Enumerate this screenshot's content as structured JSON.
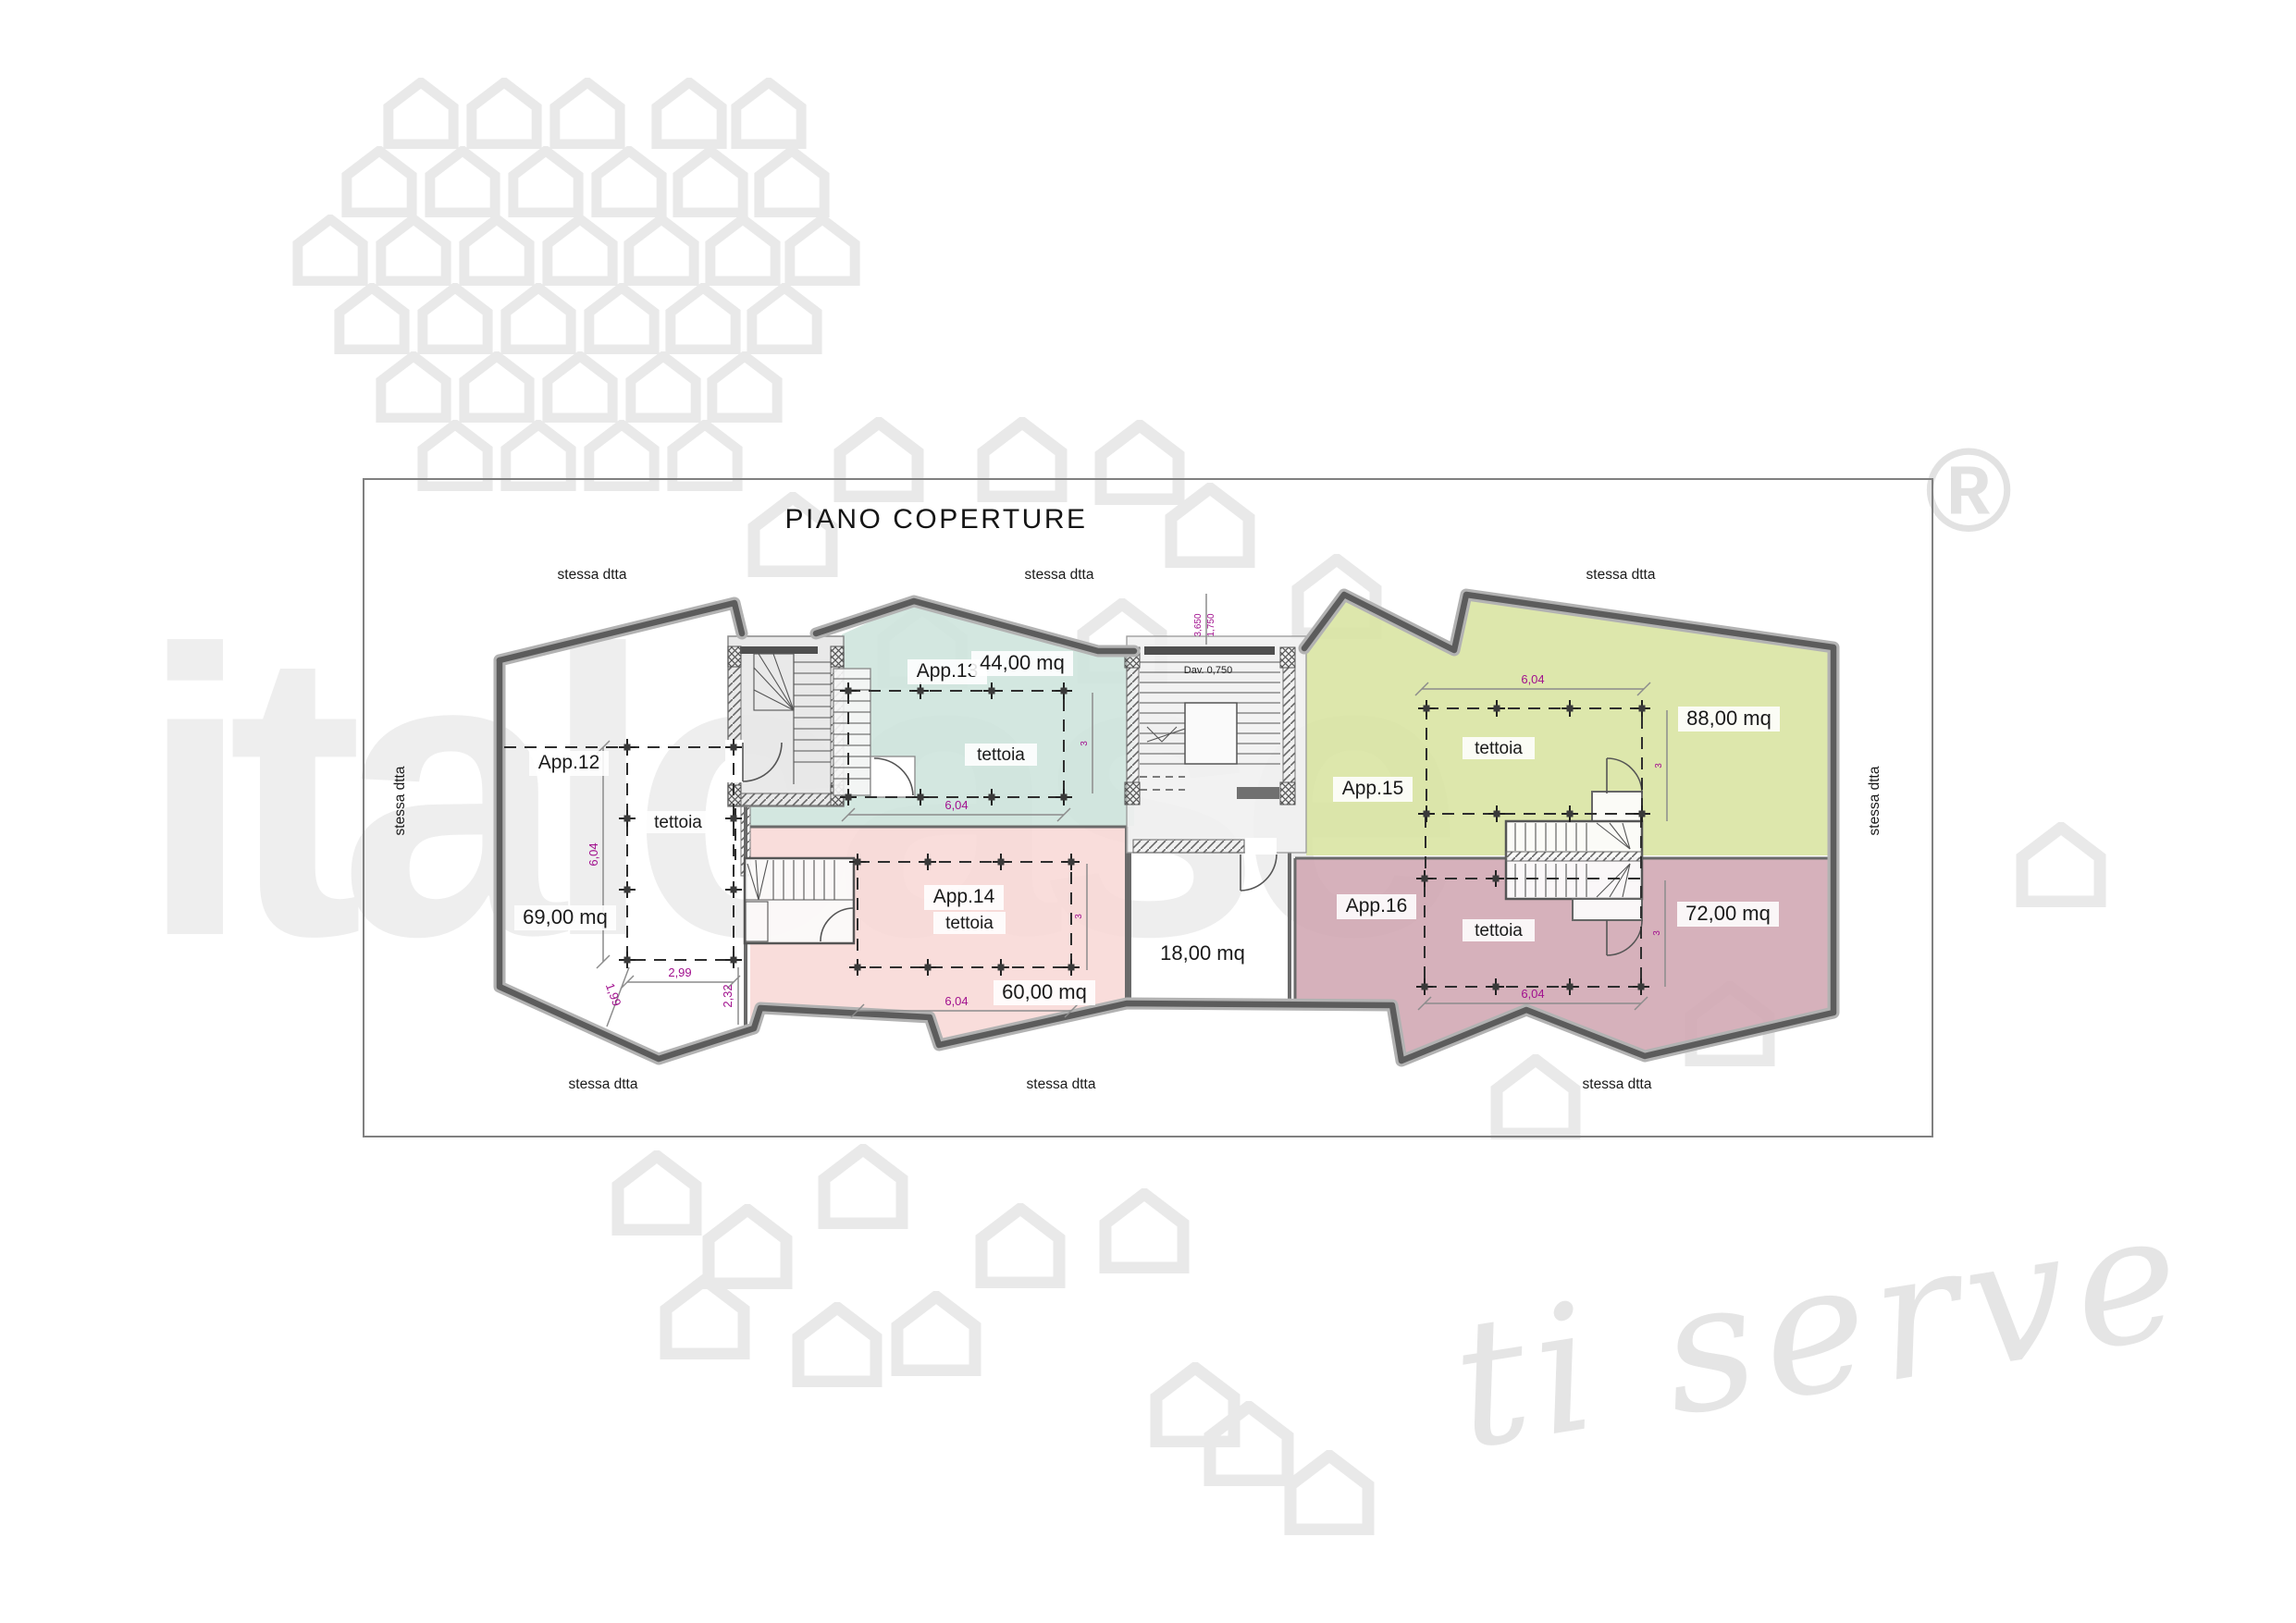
{
  "watermark": {
    "logo_text": "italcase",
    "script_text": "ti serve",
    "registered_mark": "®"
  },
  "header": {
    "title": "PIANO COPERTURE"
  },
  "plan": {
    "orientation_label": "stessa dtta",
    "apartments": [
      {
        "label": "App.12",
        "area": "69,00 mq",
        "canopy_label": "tettoia"
      },
      {
        "label": "App.13",
        "area": "44,00 mq",
        "canopy_label": "tettoia"
      },
      {
        "label": "App.14",
        "area": "60,00 mq",
        "canopy_label": "tettoia"
      },
      {
        "label": "App.15",
        "area": "88,00 mq",
        "canopy_label": "tettoia"
      },
      {
        "label": "App.16",
        "area": "72,00 mq",
        "canopy_label": "tettoia"
      }
    ],
    "stairwell_area": "18,00 mq",
    "dimensions": {
      "canopy_width": "6,04",
      "canopy_depth": "3",
      "app12_width": "2,99",
      "app12_side": "1,99",
      "app12_edge": "2,32",
      "stair_width": "1,750",
      "stair_length": "3,650",
      "stair_note": "Dav. 0,750"
    },
    "colors": {
      "app13": "#cde4dc",
      "app14": "#f8d8d6",
      "app15": "#d8e4a0",
      "app16": "#d0a6b2"
    }
  }
}
